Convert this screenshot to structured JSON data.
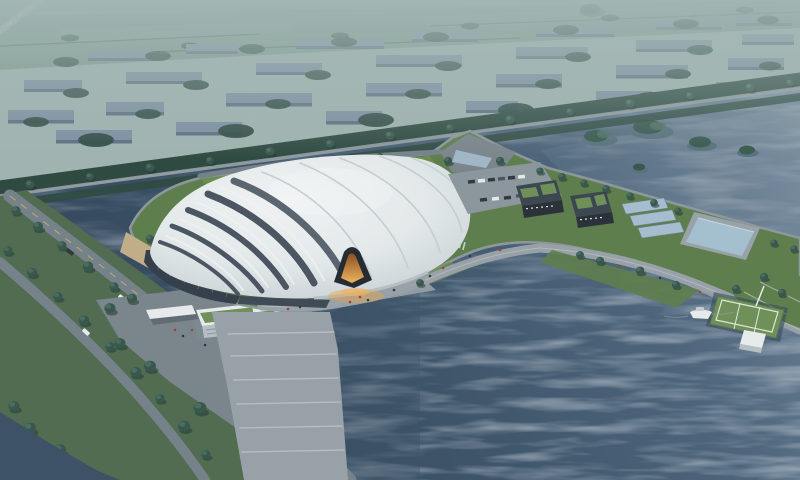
{
  "scene": {
    "type": "architectural-aerial-rendering",
    "description": "Dusk bird's-eye rendering of a large white shell-roofed gymnasium hall on a lakeside peninsula, with glowing orange entrance, waterfront promenade, green-roofed service buildings, reflecting pool, floating sports platform with boat, tree-lined roads, canals and hazy city blocks in the distance",
    "visible_text": [],
    "objects": [
      {
        "name": "main-gymnasium-building",
        "label": "White curved shell-roof hall with dark striped base and lit entrance"
      },
      {
        "name": "entrance-glow",
        "label": "Warm orange illuminated entry portal"
      },
      {
        "name": "lake",
        "label": "Large rippled lake wrapping the site"
      },
      {
        "name": "canal",
        "label": "Moat canal around the building island"
      },
      {
        "name": "city-blocks",
        "label": "Hazy rows of mid-rise blocks with street trees"
      },
      {
        "name": "fields",
        "label": "Distant green farmland band"
      },
      {
        "name": "tree-lined-road",
        "label": "Diagonal tree-lined arterial road behind the site"
      },
      {
        "name": "left-roads",
        "label": "Two tree-lined access roads with cars"
      },
      {
        "name": "l-shaped-building",
        "label": "L-shaped white office building with green roof and entry canopy"
      },
      {
        "name": "service-complex",
        "label": "Dark low buildings with roof gardens, parking lot and solar canopies"
      },
      {
        "name": "reflecting-pool",
        "label": "Rectangular reflecting pool on the peninsula"
      },
      {
        "name": "floating-field",
        "label": "Floating green sports platform with white pavilion"
      },
      {
        "name": "boat",
        "label": "Small white boat moored near the platform"
      },
      {
        "name": "islands",
        "label": "Tree-covered islets in the upper river"
      }
    ],
    "palette": {
      "bg-haze": "#a3b6b2",
      "far-city": "#85999b",
      "field": "#7e988c",
      "field-light": "#8ba495",
      "hedge": "#2c473d",
      "tree": "#35564b",
      "tree-light": "#4f7260",
      "tree-shadow": "#20362e",
      "block-top": "#7e90a3",
      "block-side": "#5b6d80",
      "water-deep": "#2e4256",
      "water-mid": "#4c647a",
      "water-light": "#74899b",
      "canal": "#3b5065",
      "road": "#76828a",
      "road-light": "#97a1a6",
      "promenade": "#9aa3a8",
      "step-light": "#c0c6c9",
      "seawall": "#8f999e",
      "lawn": "#5e7e4a",
      "lawn-light": "#70904f",
      "plaza": "#7b868c",
      "roof-white": "#f6f8f8",
      "roof-mid": "#e9eeee",
      "roof-shade": "#c9d2d6",
      "gap-dark": "#49545f",
      "facade-dark": "#333d48",
      "facade-stripe": "#5a6470",
      "glow": "#eda64a",
      "glow-deep": "#8a4d1e",
      "glow-bright": "#f4b75c",
      "green-roof": "#6f9156",
      "bldg-dark": "#3a444d",
      "bldg-darker": "#272e34",
      "solar": "#a9c0d2",
      "pool": "#a7c2d0",
      "white": "#ecf0f0",
      "car-dark": "#2e343b",
      "yellow-line": "#d8b95c",
      "person-red": "#b03a2e",
      "person-dark": "#2f353b",
      "sand": "#c6b088"
    }
  }
}
